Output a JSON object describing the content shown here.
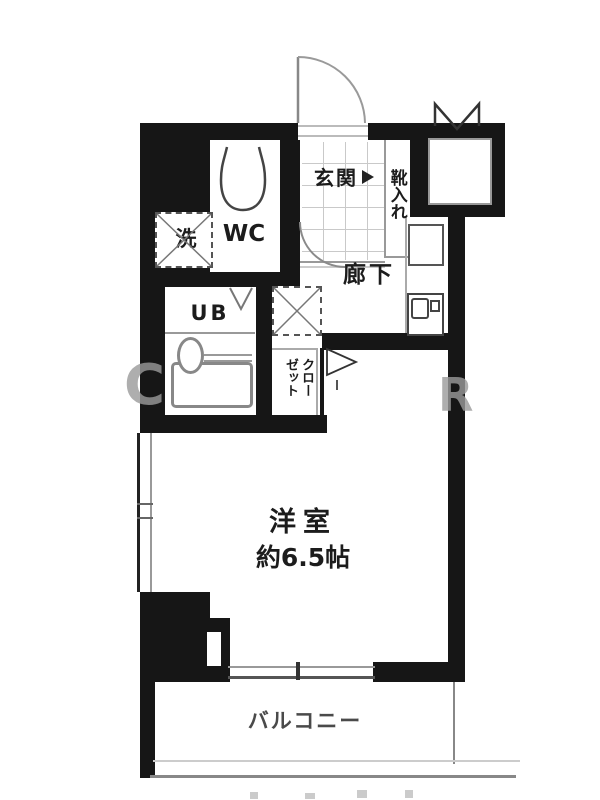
{
  "rooms": {
    "entrance": {
      "label": "玄関"
    },
    "shoe": {
      "label": "靴入れ"
    },
    "wc": {
      "label": "WC"
    },
    "laundry": {
      "label": "洗"
    },
    "hall": {
      "label": "廊下"
    },
    "bath": {
      "label": "UB"
    },
    "closet": {
      "label": "クローゼット"
    },
    "main": {
      "label": "洋室",
      "size": "約6.5帖"
    },
    "balcony": {
      "label": "バルコニー"
    }
  },
  "watermark": {
    "left": "C",
    "right": "R"
  },
  "colors": {
    "wall": "#161616",
    "thin_line": "#999999",
    "background": "#ffffff"
  }
}
